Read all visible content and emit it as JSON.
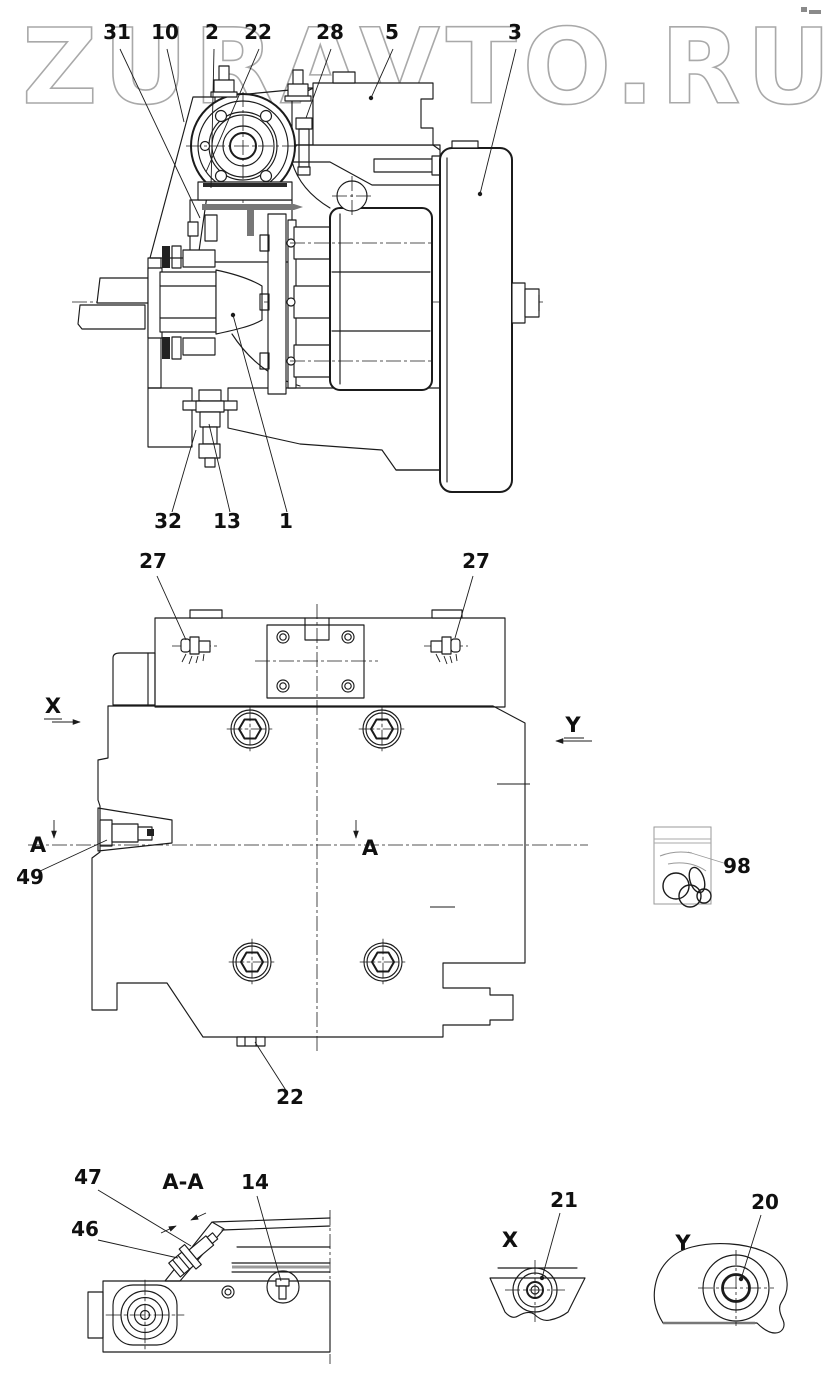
{
  "watermark": {
    "text": "ZURAVTO.RU",
    "color": "#a9a9a9"
  },
  "sectional_view": {
    "callouts_top": [
      "31",
      "10",
      "2",
      "22",
      "28",
      "5",
      "3"
    ],
    "callouts_bottom": [
      "32",
      "13",
      "1"
    ]
  },
  "plan_view": {
    "callout_27_left": "27",
    "callout_27_right": "27",
    "callout_49": "49",
    "callout_22": "22",
    "callout_98": "98",
    "view_arrow_x": "X",
    "view_arrow_y": "Y",
    "section_marker_left": "A",
    "section_marker_right": "A"
  },
  "detail_views": {
    "section_aa": {
      "title": "A-A",
      "callout_47": "47",
      "callout_46": "46",
      "callout_14": "14"
    },
    "view_x": {
      "label": "X",
      "callout_21": "21"
    },
    "view_y": {
      "label": "Y",
      "callout_20": "20"
    }
  }
}
